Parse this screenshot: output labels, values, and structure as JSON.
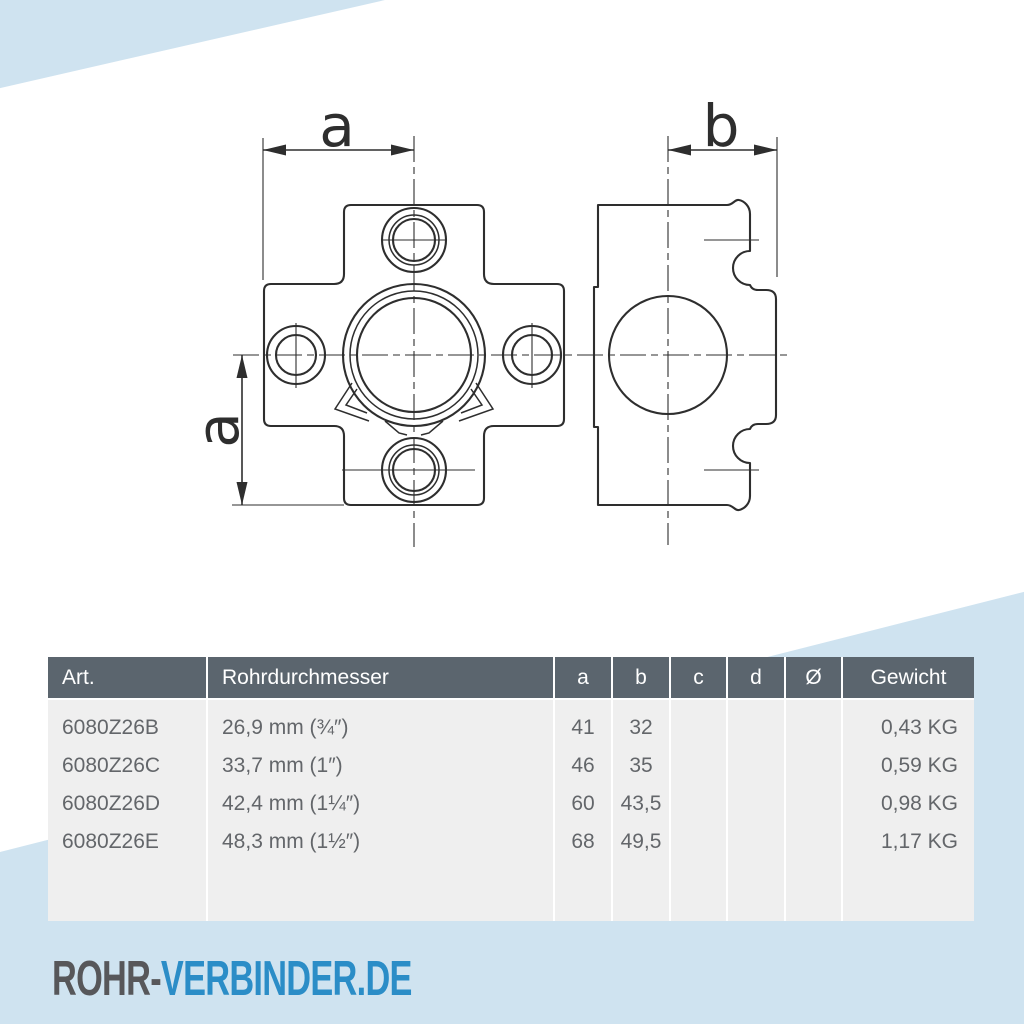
{
  "branding": {
    "logo_part1": "ROHR-",
    "logo_part2": "VERBINDER.DE"
  },
  "colors": {
    "accent_blue": "#2b8dc7",
    "logo_gray": "#57575a",
    "light_blue": "#cfe3f0",
    "table_header_bg": "#5b656e",
    "table_body_bg": "#efefef",
    "drawing_line": "#2e2e2e"
  },
  "drawing": {
    "dimension_labels": {
      "front_width": "a",
      "front_height": "a",
      "side_width": "b"
    }
  },
  "table": {
    "headers": [
      "Art.",
      "Rohrdurchmesser",
      "a",
      "b",
      "c",
      "d",
      "Ø",
      "Gewicht"
    ],
    "rows": [
      {
        "art": "6080Z26B",
        "rohrdurchmesser": "26,9 mm (¾″)",
        "a": "41",
        "b": "32",
        "c": "",
        "d": "",
        "diameter": "",
        "gewicht": "0,43 KG"
      },
      {
        "art": "6080Z26C",
        "rohrdurchmesser": "33,7 mm (1″)",
        "a": "46",
        "b": "35",
        "c": "",
        "d": "",
        "diameter": "",
        "gewicht": "0,59 KG"
      },
      {
        "art": "6080Z26D",
        "rohrdurchmesser": "42,4 mm (1¼″)",
        "a": "60",
        "b": "43,5",
        "c": "",
        "d": "",
        "diameter": "",
        "gewicht": "0,98 KG"
      },
      {
        "art": "6080Z26E",
        "rohrdurchmesser": "48,3 mm (1½″)",
        "a": "68",
        "b": "49,5",
        "c": "",
        "d": "",
        "diameter": "",
        "gewicht": "1,17 KG"
      }
    ]
  }
}
